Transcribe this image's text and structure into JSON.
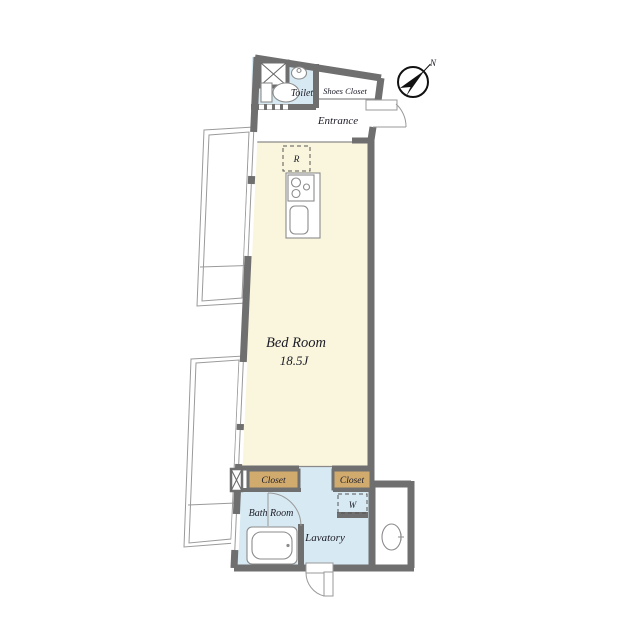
{
  "plan": {
    "type": "apartment-floor-plan",
    "compass_label": "N",
    "rooms": {
      "toilet": "Toilet",
      "shoes_closet": "Shoes Closet",
      "entrance": "Entrance",
      "bedroom_name": "Bed Room",
      "bedroom_size": "18.5J",
      "closet_left": "Closet",
      "closet_right": "Closet",
      "bathroom": "Bath Room",
      "lavatory": "Lavatory"
    },
    "symbols": {
      "refrigerator": "R",
      "washing_machine": "W"
    },
    "colors": {
      "wall": "#6f6f6f",
      "bedroom_fill": "#faf6dd",
      "wet_area_fill": "#d7e9f2",
      "closet_fill": "#d1ab6e",
      "balcony_line": "#9a9a9a"
    }
  }
}
